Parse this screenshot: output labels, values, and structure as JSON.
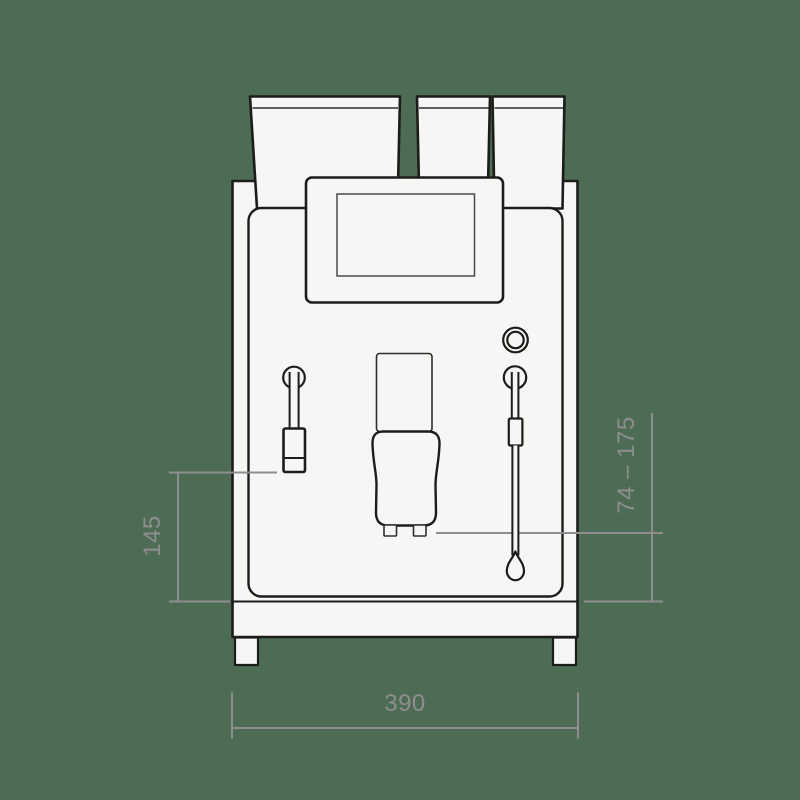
{
  "drawing_title": "espresso-machine-front-view-technical-drawing",
  "dimensions": {
    "height_left": "145",
    "spout_height_range": "74 – 175",
    "width_bottom": "390"
  },
  "colors": {
    "background": "#4d6c53",
    "outline": "#1c1c1a",
    "detail_outline": "#2e2e2c",
    "screen_outline": "#4a4a48",
    "body_fill": "#f6f6f4",
    "dimension": "#8e8e8e"
  }
}
